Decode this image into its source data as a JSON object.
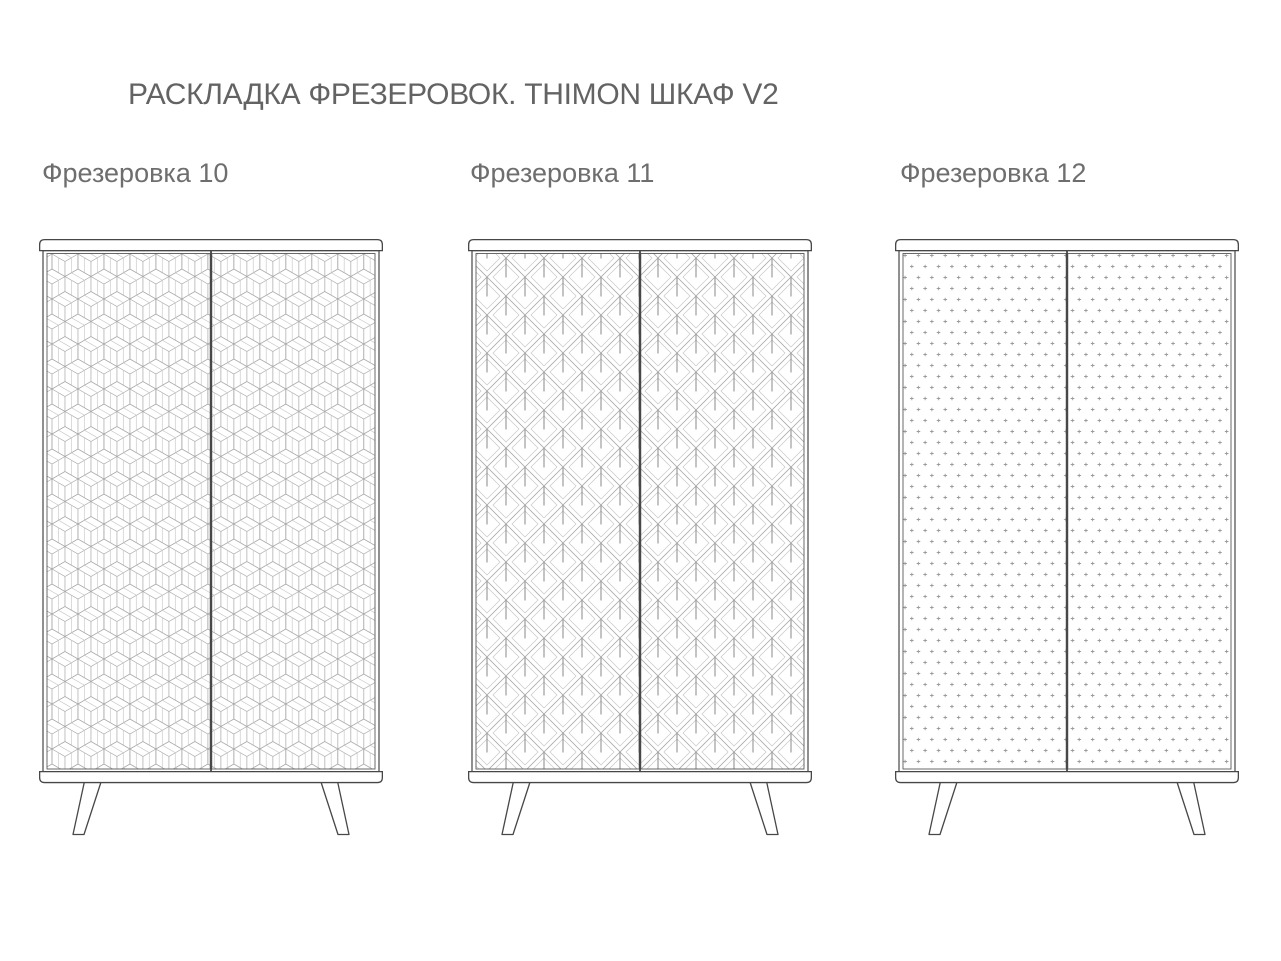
{
  "title": "РАСКЛАДКА ФРЕЗЕРОВОК. THIMON ШКАФ V2",
  "figures": [
    {
      "label": "Фрезеровка 10",
      "pattern": "isometric-cubes-parquet"
    },
    {
      "label": "Фрезеровка 11",
      "pattern": "nested-diamonds-with-stems"
    },
    {
      "label": "Фрезеровка 12",
      "pattern": "staggered-cross-dots"
    }
  ],
  "colors": {
    "background": "#ffffff",
    "title_text": "#636363",
    "label_text": "#6e6e6e",
    "cabinet_outline": "#474747",
    "door_frame": "#5a5a5a",
    "pattern_line": "#adadad",
    "pattern_line_light": "#c8c8c8",
    "pattern_line_dark": "#8a8a8a"
  }
}
